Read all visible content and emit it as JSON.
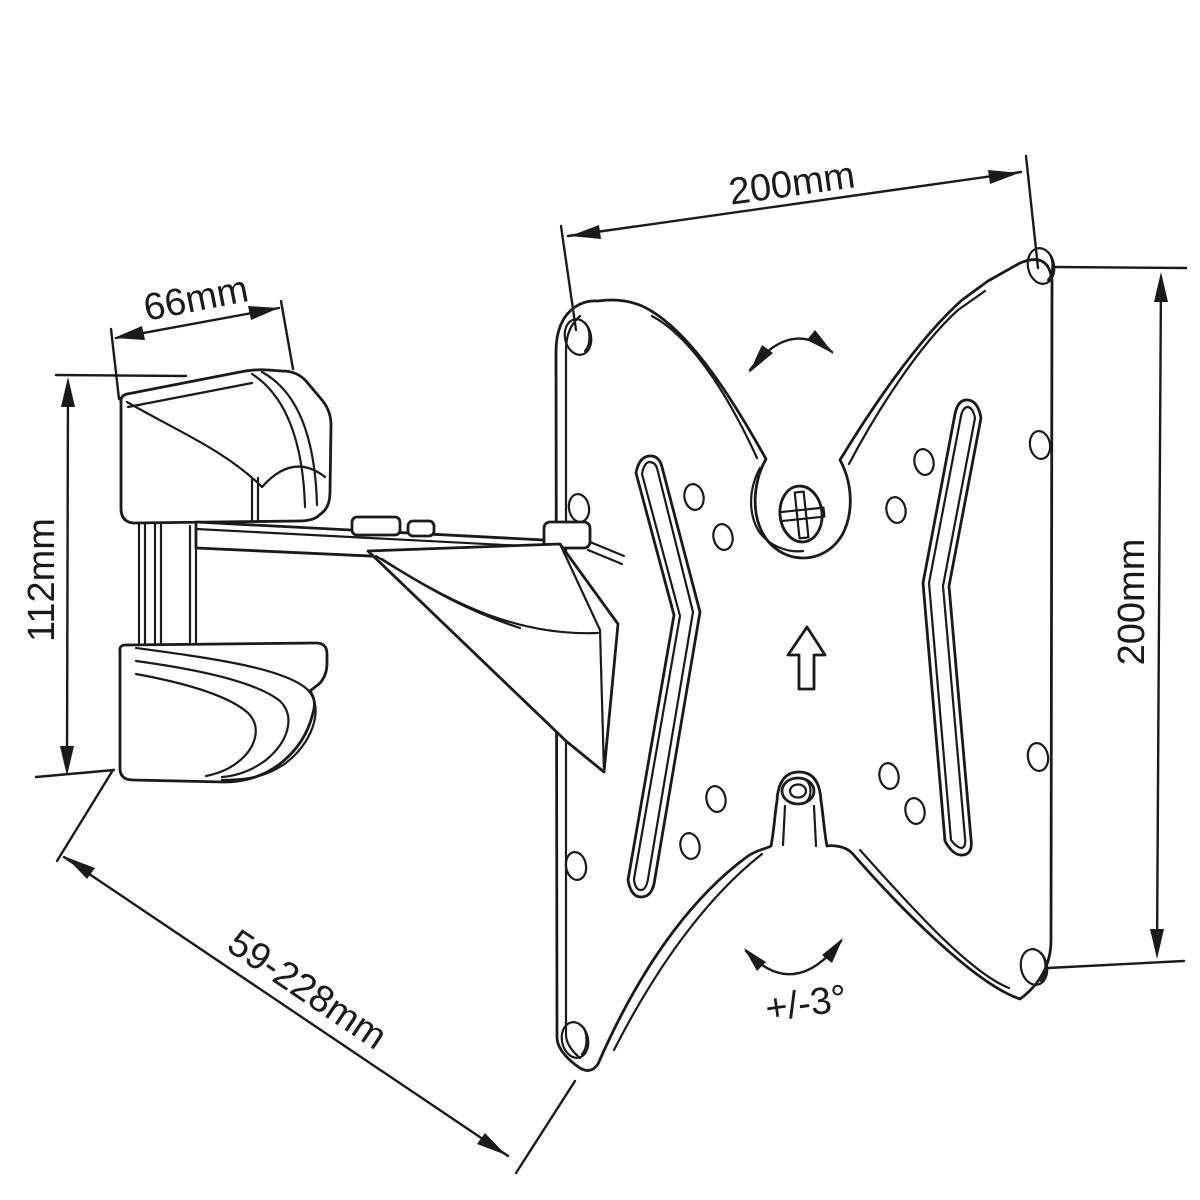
{
  "drawing": {
    "type": "technical-line-drawing",
    "subject": "Articulating TV wall mount bracket with VESA plate",
    "background_color": "#ffffff",
    "line_color": "#1a1a1a"
  },
  "dimensions": {
    "vesa_plate_width": "200mm",
    "vesa_plate_height": "200mm",
    "wall_bracket_width": "66mm",
    "wall_bracket_height": "112mm",
    "arm_extension_range": "59-228mm",
    "tilt_angle_range": "+/-3°"
  }
}
